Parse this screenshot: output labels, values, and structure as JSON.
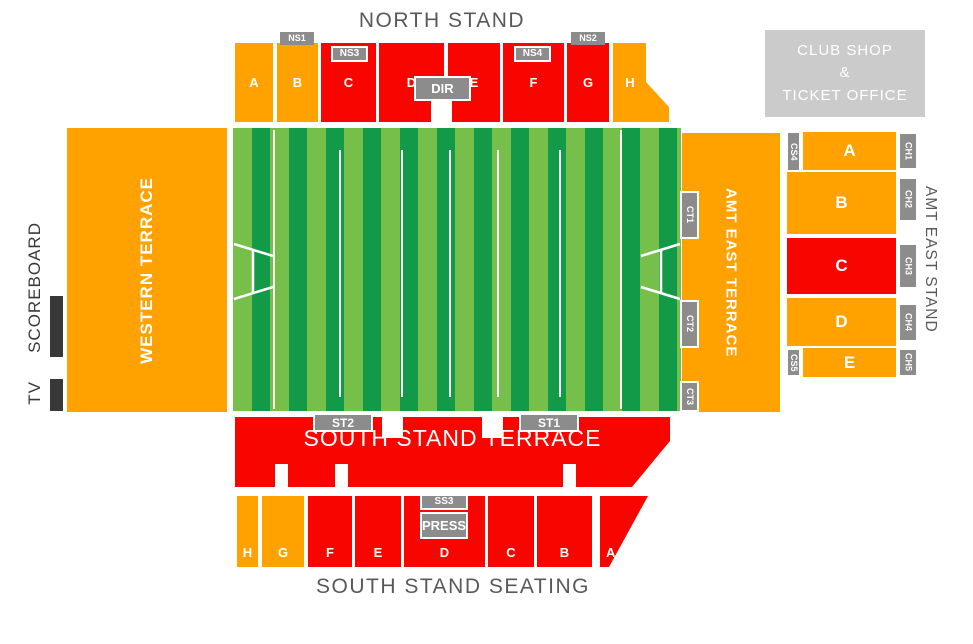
{
  "colors": {
    "orange": "#FFA200",
    "red": "#F90500",
    "pitch_light": "#76BF4B",
    "pitch_dark": "#129A49",
    "gate_gray": "#8C8C8C",
    "clubshop_gray": "#CBCBCB",
    "title_gray": "#58595B",
    "scoreboard_black": "#383838"
  },
  "north_stand": {
    "title": "NORTH STAND",
    "sections": [
      "A",
      "B",
      "C",
      "D",
      "E",
      "F",
      "G",
      "H"
    ],
    "gates": {
      "ns1": "NS1",
      "ns2": "NS2",
      "ns3": "NS3",
      "ns4": "NS4"
    },
    "director_box": "DIR"
  },
  "west": {
    "tv": "TV",
    "scoreboard": "SCOREBOARD",
    "terrace": "WESTERN TERRACE"
  },
  "east": {
    "terrace": "AMT EAST TERRACE",
    "stand_title": "AMT EAST STAND",
    "terrace_gates": [
      "CT1",
      "CT2",
      "CT3"
    ],
    "stand_sections": [
      "A",
      "B",
      "C",
      "D",
      "E"
    ],
    "corner_gates": [
      "CS4",
      "CS5"
    ],
    "stand_gates": [
      "CH1",
      "CH2",
      "CH3",
      "CH4",
      "CH5"
    ]
  },
  "south_terrace": {
    "label": "SOUTH STAND TERRACE",
    "gates": {
      "st1": "ST1",
      "st2": "ST2"
    }
  },
  "south_seating": {
    "title": "SOUTH STAND SEATING",
    "sections": [
      "H",
      "G",
      "F",
      "E",
      "D",
      "C",
      "B",
      "A"
    ],
    "gates": {
      "ss3": "SS3",
      "press": "PRESS"
    }
  },
  "club_shop": {
    "line1": "CLUB SHOP",
    "line2": "&",
    "line3": "TICKET OFFICE"
  }
}
